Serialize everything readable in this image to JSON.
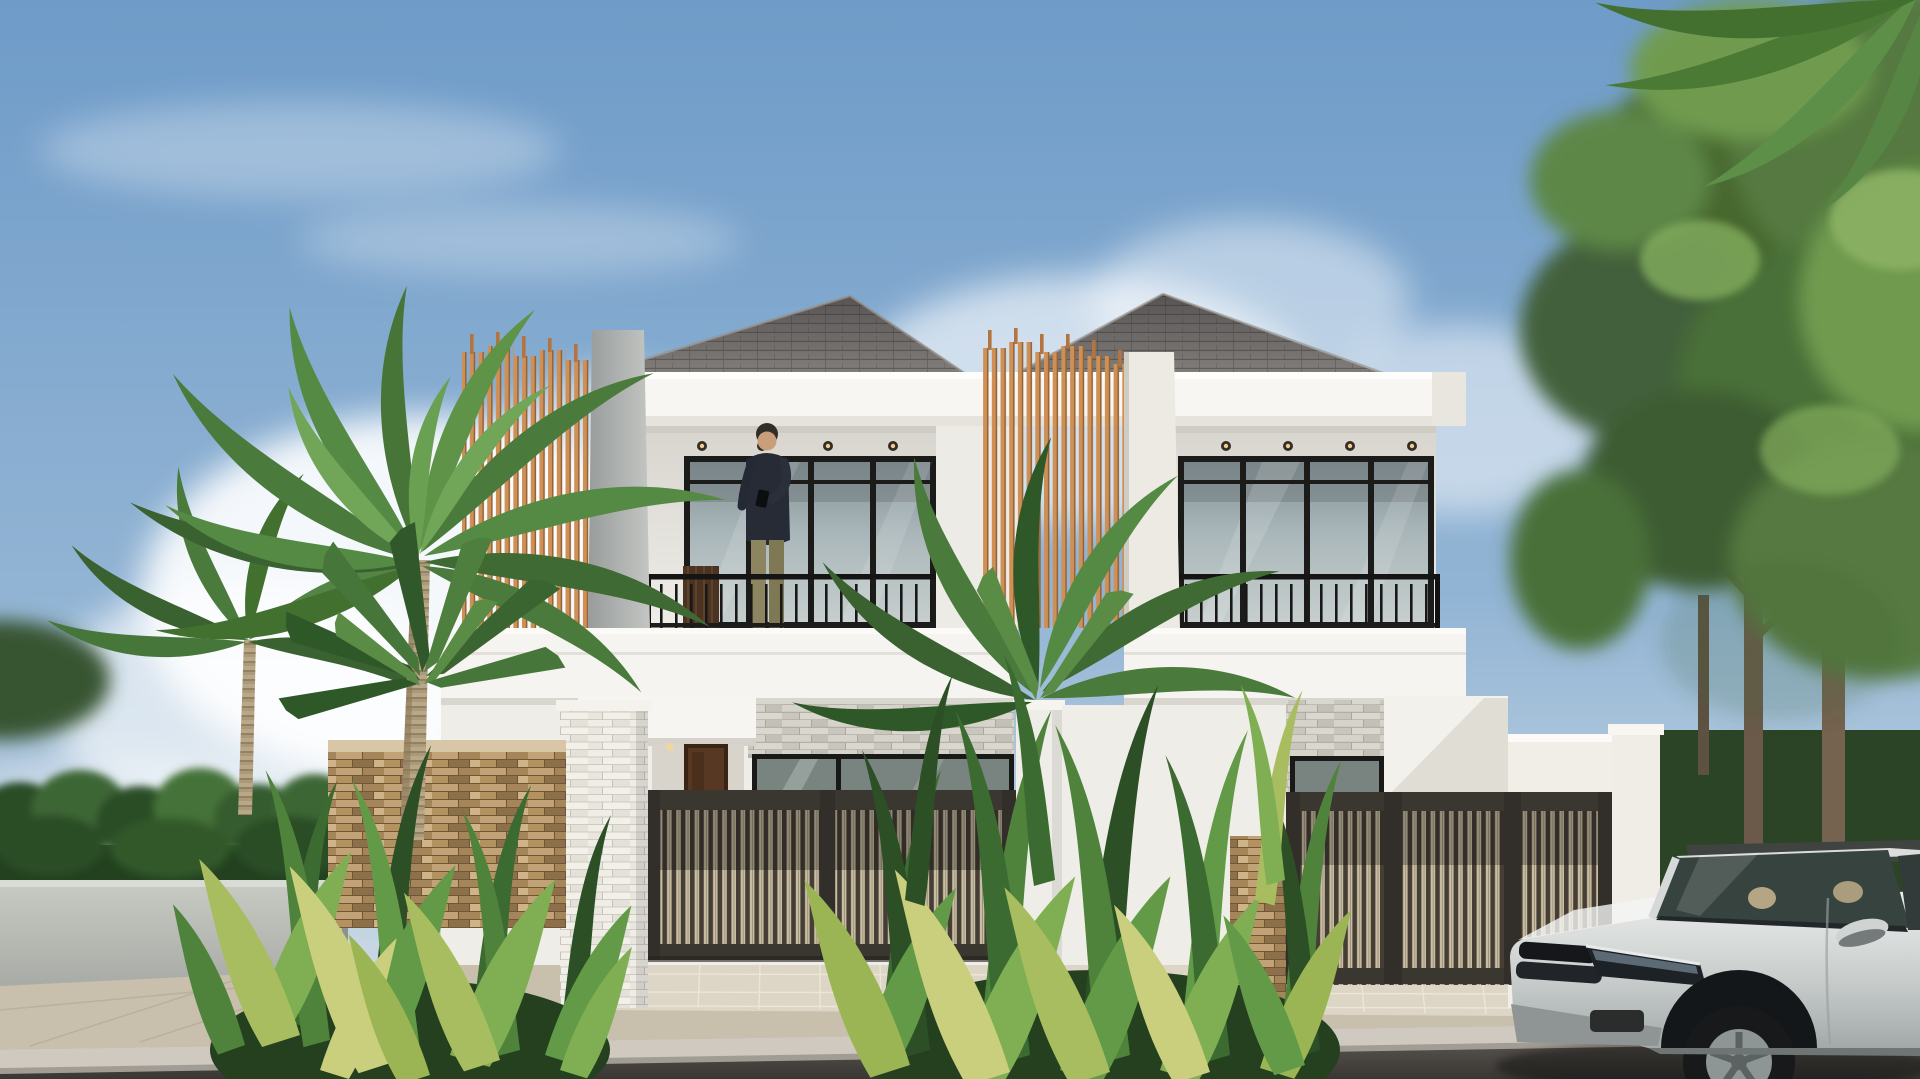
{
  "aria": {
    "scene": "3D architectural rendering of a modern two-story twin villa with wooden slat screens, balconies, tropical plants, palm trees and a parked silver SUV",
    "sky": "Blue sky with soft white clouds",
    "building": "White duplex villa with hip roofs and wood slat feature panels",
    "left_unit": "Left villa unit with balcony and person standing at railing",
    "right_unit": "Right villa unit with balcony",
    "person": "Man standing on balcony looking at phone",
    "palm": "Tall palm tree on the left",
    "trees": "Green trees on the right",
    "car": "Silver SUV parked on the street",
    "gate_left": "Dark slatted entrance gate of left unit",
    "gate_right": "Dark slatted entrance gate of right unit",
    "road": "Asphalt road and paved sidewalk in the foreground",
    "plants": "Tropical shrubs and ornamental plants along the fence"
  },
  "palette": {
    "sky_top": "#6e9bc8",
    "sky_bottom": "#c3d4e2",
    "wall_white": "#f5f4f0",
    "roof_gray": "#6e6b67",
    "wood_slat": "#b06f38",
    "gate_dark": "#453e35",
    "stone_tan": "#b3925f",
    "stone_gray": "#cdcac2",
    "leaf_green": "#4f833c",
    "car_silver": "#c6cbcb",
    "road_asphalt": "#4a4642"
  },
  "objects": [
    "sky",
    "clouds",
    "right-trees",
    "left-palms",
    "hedge",
    "duplex-building",
    "wood-slat-screens",
    "balconies",
    "railings",
    "person",
    "gates",
    "stone-walls",
    "pillars",
    "plants",
    "car",
    "sidewalk",
    "road"
  ]
}
